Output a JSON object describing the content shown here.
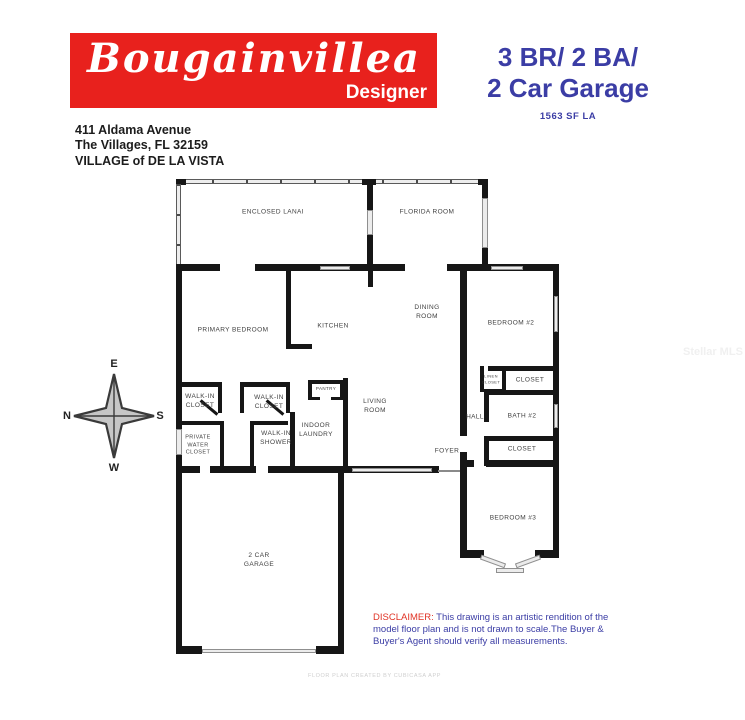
{
  "header": {
    "model_name": "Bougainvillea",
    "model_tier": "Designer",
    "banner_color": "#e8211d",
    "accent_blue": "#3b3da5",
    "address_line1": "411 Aldama Avenue",
    "address_line2": "The Villages, FL 32159",
    "address_line3": "VILLAGE of DE LA VISTA",
    "spec_line1": "3 BR/ 2 BA/",
    "spec_line2": "2 Car Garage",
    "sqft": "1563 SF LA"
  },
  "compass": {
    "top": "E",
    "right": "S",
    "bottom": "W",
    "left": "N"
  },
  "floor_plan": {
    "rooms": [
      {
        "label": "ENCLOSED LANAI",
        "x": 273,
        "y": 212
      },
      {
        "label": "FLORIDA ROOM",
        "x": 427,
        "y": 212
      },
      {
        "label": "PRIMARY BEDROOM",
        "x": 233,
        "y": 330
      },
      {
        "label": "KITCHEN",
        "x": 333,
        "y": 326
      },
      {
        "label": "DINING\nROOM",
        "x": 427,
        "y": 312
      },
      {
        "label": "BEDROOM #2",
        "x": 511,
        "y": 323
      },
      {
        "label": "LINEN\nCLOSET",
        "x": 491,
        "y": 379,
        "fs": 4
      },
      {
        "label": "CLOSET",
        "x": 530,
        "y": 380
      },
      {
        "label": "HALL",
        "x": 475,
        "y": 417
      },
      {
        "label": "BATH #2",
        "x": 522,
        "y": 416
      },
      {
        "label": "CLOSET",
        "x": 522,
        "y": 449
      },
      {
        "label": "FOYER",
        "x": 447,
        "y": 451
      },
      {
        "label": "LIVING\nROOM",
        "x": 375,
        "y": 406
      },
      {
        "label": "WALK-IN\nCLOSET",
        "x": 200,
        "y": 401
      },
      {
        "label": "WALK-IN\nCLOSET",
        "x": 269,
        "y": 402
      },
      {
        "label": "PRIVATE\nWATER\nCLOSET",
        "x": 198,
        "y": 446,
        "fs": 5.5
      },
      {
        "label": "WALK-IN\nSHOWER",
        "x": 276,
        "y": 438
      },
      {
        "label": "INDOOR\nLAUNDRY",
        "x": 316,
        "y": 430
      },
      {
        "label": "PANTRY",
        "x": 326,
        "y": 389,
        "fs": 4.5
      },
      {
        "label": "BEDROOM #3",
        "x": 513,
        "y": 518
      },
      {
        "label": "2 CAR\nGARAGE",
        "x": 259,
        "y": 560
      }
    ]
  },
  "disclaimer": {
    "label": "DISCLAIMER:",
    "text": " This drawing is an artistic rendition of the model floor plan and is not drawn to scale.The Buyer & Buyer's Agent should verify all measurements."
  },
  "watermarks": {
    "footer": "FLOOR PLAN CREATED BY CUBICASA APP",
    "side": "Stellar MLS"
  }
}
